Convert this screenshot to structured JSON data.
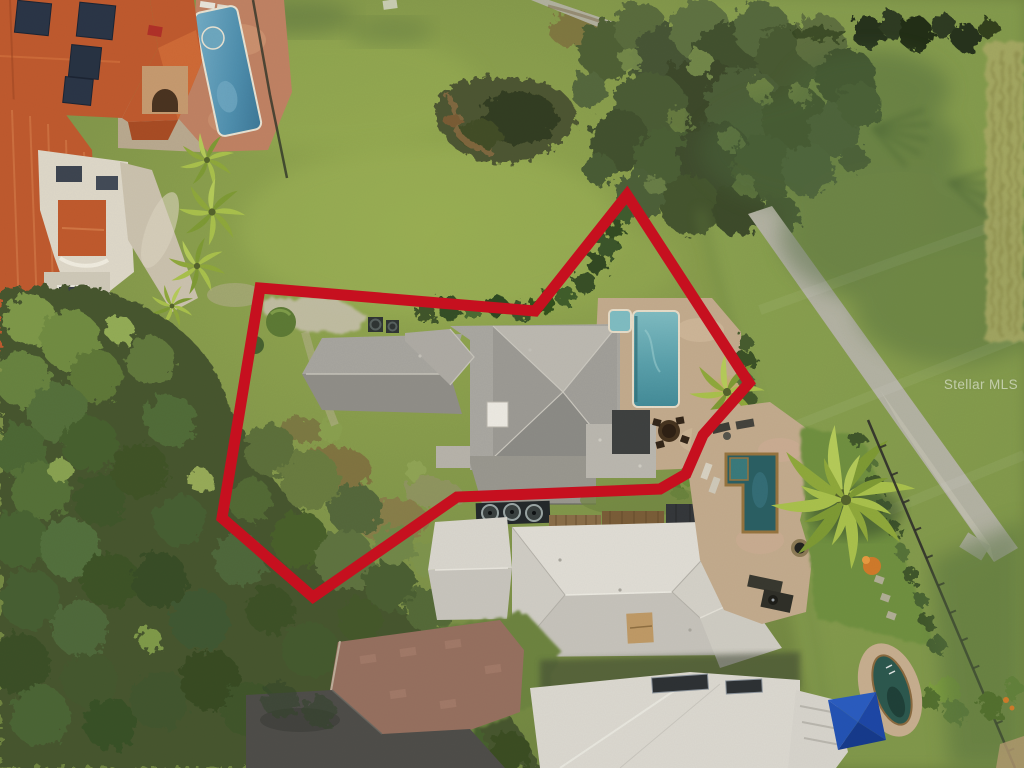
{
  "image": {
    "description": "Aerial drone photo of a residential lot outlined with a thick red boundary; gray-shingle house with rectangular teal pool, bordered left by oak tree canopy, top-left by terracotta-roof condos with a blue pool, right by a golf-course fairway with a diagonal cart path, bottom by neighboring homes with white roofs, brick driveway, an L-shaped spa pool, a kidney pool and a blue cabana canopy.",
    "width_px": 1024,
    "height_px": 768
  },
  "watermark": {
    "text": "Stellar MLS"
  },
  "scene": {
    "boundary_points": "260,288 535,311 627,195 749,383 703,435 686,474 660,489 457,497 313,597 222,518"
  },
  "colors": {
    "boundary-red": "#c9101f",
    "lawn-green": "#7e9247",
    "golf-green": "#8ba351",
    "tree-dark": "#47572f",
    "tree-light": "#88a24f",
    "roof-gray": "#a3a19b",
    "roof-white": "#d9d6ce",
    "roof-terracotta": "#bf5a2e",
    "pool-teal": "#5aa0ab",
    "pool-blue": "#4f8fae",
    "pool-dark-teal": "#2a5f63",
    "deck-tan": "#c3ab8d",
    "deck-salmon": "#c08263",
    "brick-drive": "#96705f",
    "road-asphalt": "#4e4d49",
    "canopy-blue": "#2353b4",
    "path-gray": "#b3b2a3"
  }
}
